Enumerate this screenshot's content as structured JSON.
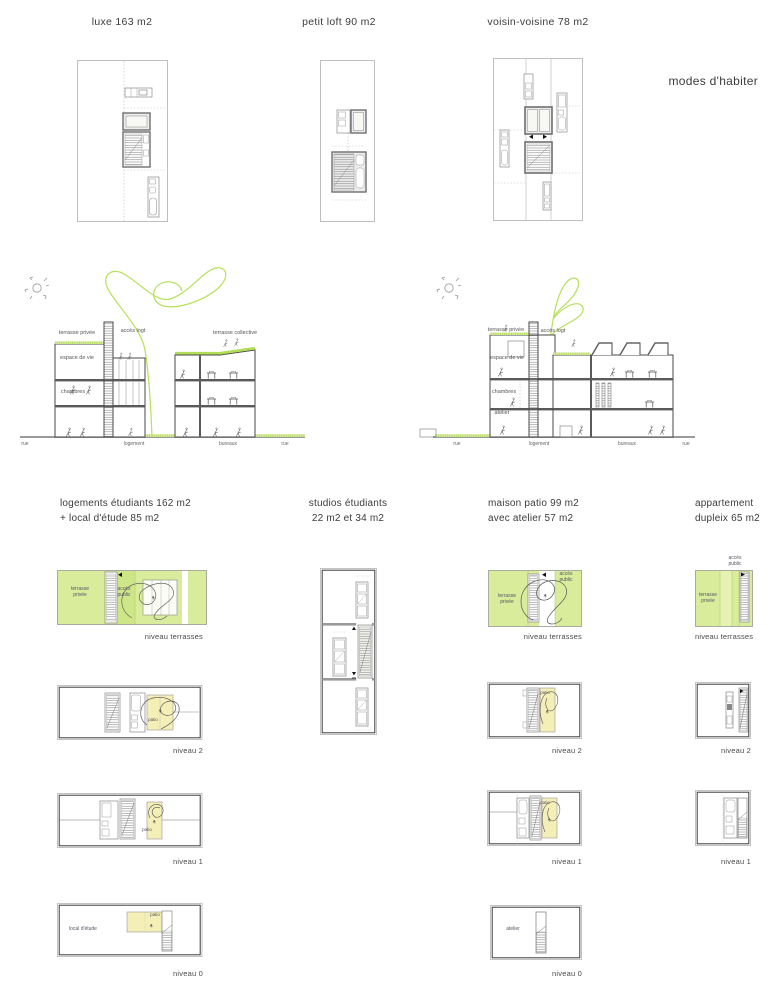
{
  "sheet_title": "modes d'habiter",
  "colors": {
    "lime": "#d9ec9b",
    "lime-light": "#e6f2b0",
    "lime-access": "#cfe687",
    "lime-stroke": "#b5e05a",
    "patio": "#f4eeb7",
    "ink": "#3c3c3c"
  },
  "top_plans": [
    {
      "label": "luxe 163 m2"
    },
    {
      "label": "petit loft 90 m2"
    },
    {
      "label": "voisin-voisine 78 m2"
    }
  ],
  "section_left": {
    "terrasse_privee": "terrasse privée",
    "acces_logt": "accès logt",
    "terrasse_collective": "terrasse collective",
    "espace_de_vie": "espace de vie",
    "chambres": "chambres",
    "rue_left": "rue",
    "logement": "logement",
    "bureaux": "bureaux",
    "rue_right": "rue"
  },
  "section_right": {
    "terrasse_privee": "terrasse privée",
    "acces_logt": "accès logt",
    "espace_de_vie": "espace de vie",
    "chambres": "chambres",
    "atelier": "atelier",
    "rue_left": "rue",
    "logement": "logement",
    "bureaux": "bureaux",
    "rue_right": "rue"
  },
  "columns": [
    {
      "title_line1": "logements étudiants 162 m2",
      "title_line2": "+ local d'étude 85 m2",
      "niveau_terrasses": "niveau terrasses",
      "niveau_2": "niveau 2",
      "niveau_1": "niveau 1",
      "niveau_0": "niveau 0",
      "terrasse_l1": "terrasse",
      "terrasse_l2": "privée",
      "acces_l1": "accès",
      "acces_l2": "public",
      "patio_n2": "patio",
      "patio_n1": "patio",
      "patio_n0": "patio",
      "local_detude": "local d'étude"
    },
    {
      "title_line1": "studios étudiants",
      "title_line2": "22 m2 et 34 m2"
    },
    {
      "title_line1": "maison patio 99 m2",
      "title_line2": "avec atelier 57 m2",
      "niveau_terrasses": "niveau terrasses",
      "niveau_2": "niveau 2",
      "niveau_1": "niveau 1",
      "niveau_0": "niveau 0",
      "terrasse_l1": "terrasse",
      "terrasse_l2": "privée",
      "acces_l1": "accès",
      "acces_l2": "public",
      "patio_n2": "patio",
      "patio_n1": "patio",
      "atelier": "atelier"
    },
    {
      "title_line1": "appartement",
      "title_line2": "dupleix 65 m2",
      "niveau_terrasses": "niveau terrasses",
      "niveau_2": "niveau 2",
      "niveau_1": "niveau 1",
      "acces_l1": "accès",
      "acces_l2": "public",
      "terrasse_l1": "terrasse",
      "terrasse_l2": "privée"
    }
  ]
}
